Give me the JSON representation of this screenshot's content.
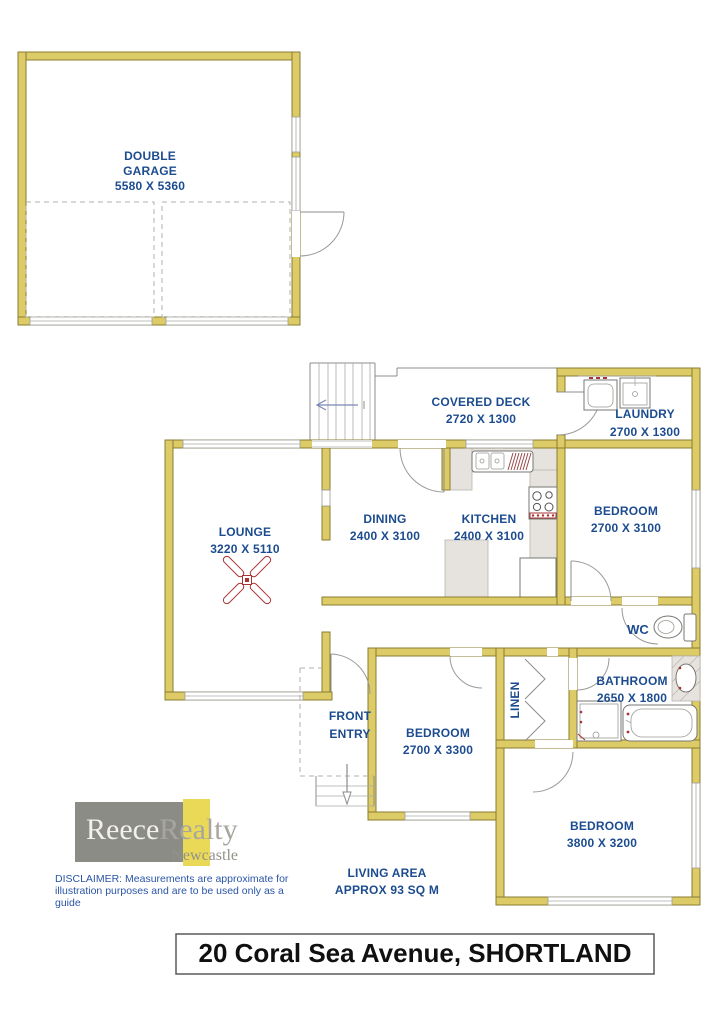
{
  "rooms": {
    "garage": {
      "name_line1": "DOUBLE",
      "name_line2": "GARAGE",
      "dims": "5580 X 5360"
    },
    "covered_deck": {
      "name": "COVERED DECK",
      "dims": "2720 X 1300"
    },
    "laundry": {
      "name": "LAUNDRY",
      "dims": "2700 X 1300"
    },
    "lounge": {
      "name": "LOUNGE",
      "dims": "3220 X 5110"
    },
    "dining": {
      "name": "DINING",
      "dims": "2400 X 3100"
    },
    "kitchen": {
      "name": "KITCHEN",
      "dims": "2400 X 3100"
    },
    "bedroom_top": {
      "name": "BEDROOM",
      "dims": "2700 X 3100"
    },
    "wc": {
      "name": "WC"
    },
    "bathroom": {
      "name": "BATHROOM",
      "dims": "2650 X 1800"
    },
    "linen": {
      "name": "LINEN"
    },
    "front_entry": {
      "line1": "FRONT",
      "line2": "ENTRY"
    },
    "bedroom_mid": {
      "name": "BEDROOM",
      "dims": "2700 X 3300"
    },
    "bedroom_bottom": {
      "name": "BEDROOM",
      "dims": "3800 X 3200"
    }
  },
  "living_area": {
    "line1": "LIVING AREA",
    "line2": "APPROX 93 SQ M"
  },
  "disclaimer": {
    "lines": [
      "DISCLAIMER: Measurements are approximate for",
      "illustration purposes and are to be used only as a",
      "guide"
    ]
  },
  "logo": {
    "brand_first": "Reece",
    "brand_second": "Realty",
    "city": "Newcastle"
  },
  "footer": {
    "address": "20 Coral Sea Avenue, SHORTLAND"
  },
  "colors": {
    "wall_yellow": "#dccb66",
    "wall_outline": "#8a7d33",
    "label_blue": "#1c4c8f",
    "fixture_red": "#a93434",
    "brand_gray": "#8c8c86",
    "brand_yellow": "#ead957",
    "disclaimer_blue": "#2a55a8"
  }
}
